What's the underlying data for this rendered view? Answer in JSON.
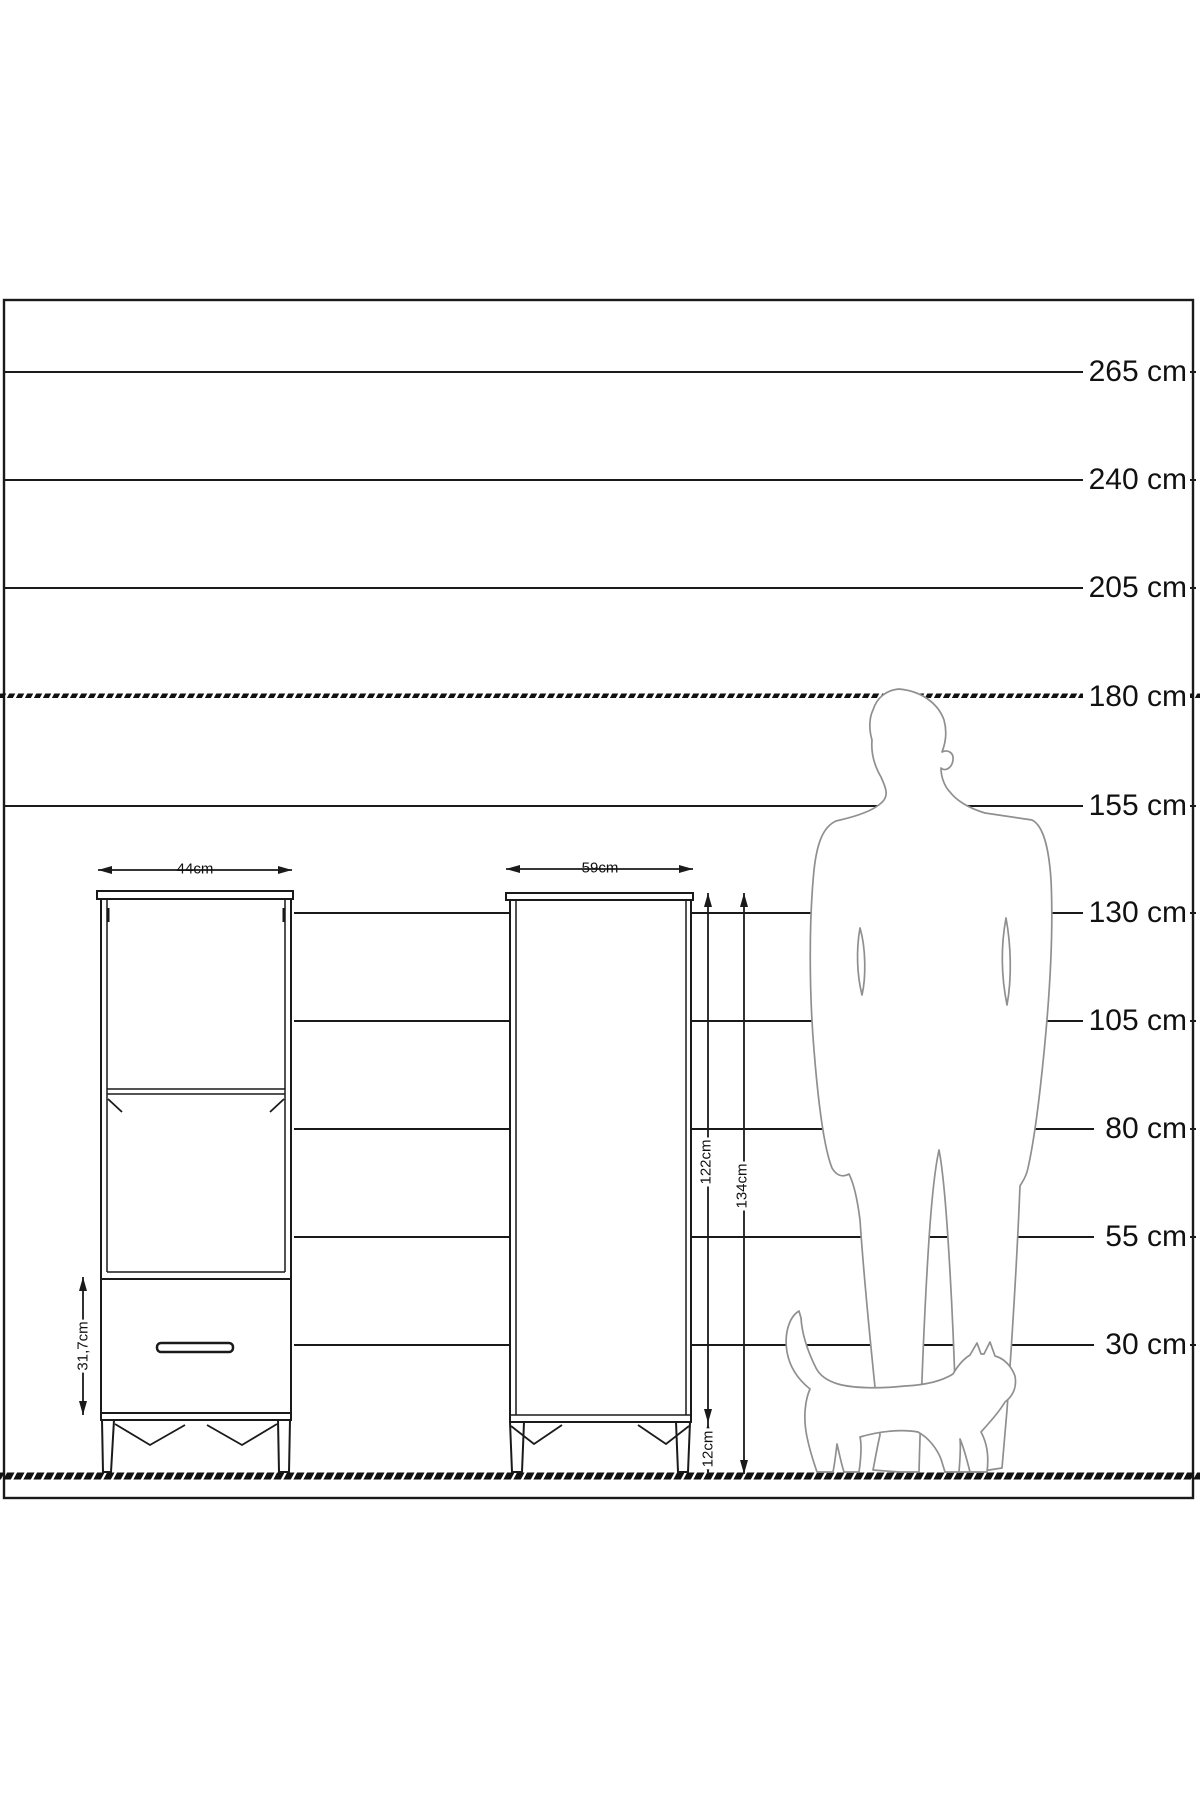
{
  "title": "furniture-height-scale-diagram",
  "unit": "cm",
  "colors": {
    "background": "#ffffff",
    "line": "#1a1a1a",
    "silhouette": "#8f8f8f"
  },
  "scale": {
    "labels": [
      {
        "text": "265 cm"
      },
      {
        "text": "240 cm"
      },
      {
        "text": "205 cm"
      },
      {
        "text": "180 cm"
      },
      {
        "text": "155 cm"
      },
      {
        "text": "130 cm"
      },
      {
        "text": "105 cm"
      },
      {
        "text": "80 cm"
      },
      {
        "text": "55 cm"
      },
      {
        "text": "30 cm"
      }
    ]
  },
  "furniture": {
    "left_cabinet": {
      "width_label": "44cm",
      "drawer_height_label": "31,7cm"
    },
    "right_cabinet": {
      "width_label": "59cm",
      "body_height_label": "122cm",
      "total_height_label": "134cm",
      "leg_height_label": "12cm"
    }
  },
  "figures": {
    "man": "man-silhouette (180 cm reference)",
    "cat": "cat-silhouette"
  }
}
